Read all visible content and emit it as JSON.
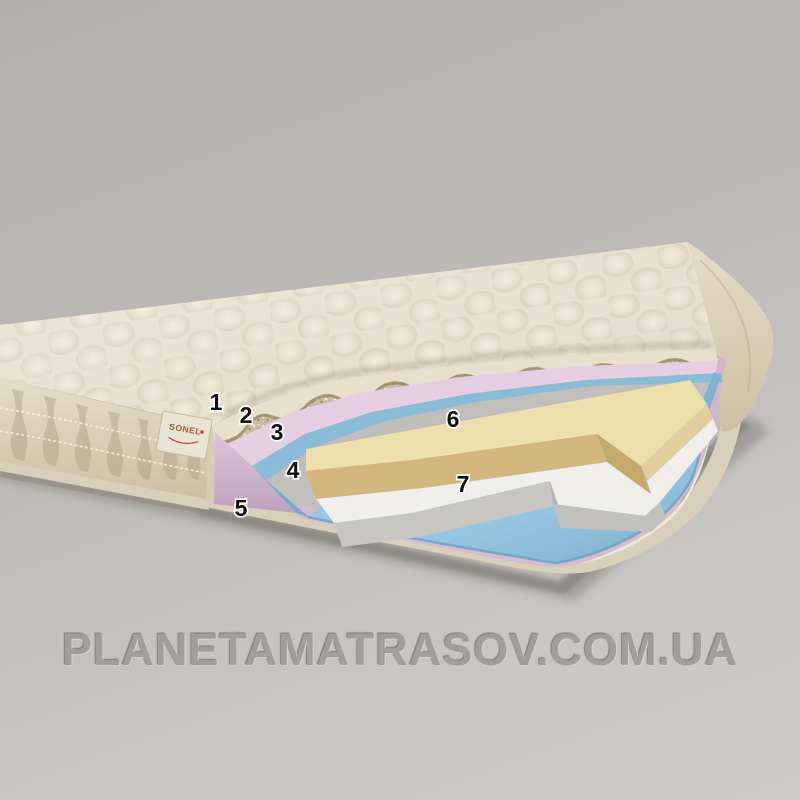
{
  "scene": {
    "description": "Cutaway 3D diagram of a thin mattress (topper) showing internal layers",
    "background_top": "#b2b0ad",
    "background_bottom": "#cdcbc8"
  },
  "watermark": {
    "text": "PLANETAMATRASOV.COM.UA",
    "color": "#a19f9b"
  },
  "tag": {
    "brand": "SONEL",
    "color": "#b2573b"
  },
  "callouts": [
    {
      "label": "1",
      "x": 216,
      "y": 410
    },
    {
      "label": "2",
      "x": 246,
      "y": 423
    },
    {
      "label": "3",
      "x": 277,
      "y": 440
    },
    {
      "label": "4",
      "x": 293,
      "y": 478
    },
    {
      "label": "5",
      "x": 241,
      "y": 516
    },
    {
      "label": "6",
      "x": 453,
      "y": 427
    },
    {
      "label": "7",
      "x": 463,
      "y": 492
    }
  ],
  "layers": [
    {
      "number": "1",
      "name": "quilted-top-cover",
      "color": "#e9e1cf"
    },
    {
      "number": "2",
      "name": "fiber-batting-layer",
      "color": "#c9bc9f"
    },
    {
      "number": "3",
      "name": "pink-foam-layer",
      "color": "#e7cfe3"
    },
    {
      "number": "4",
      "name": "blue-thin-layer",
      "color": "#8abcd8"
    },
    {
      "number": "5",
      "name": "bottom-cover-edge",
      "color": "#d9d0bb"
    },
    {
      "number": "6",
      "name": "yellow-foam-block",
      "color": "#eee0ad"
    },
    {
      "number": "7",
      "name": "white-foam-block",
      "color": "#f0efeb"
    }
  ]
}
